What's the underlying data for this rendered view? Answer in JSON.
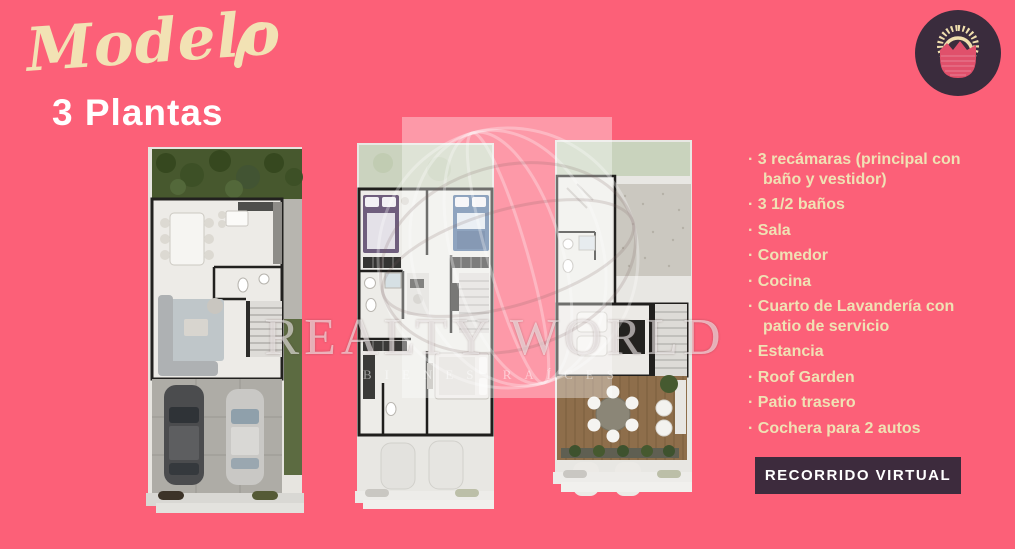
{
  "header": {
    "script_title": "Modelo",
    "subtitle": "3 Plantas"
  },
  "logo": {
    "icon": "sun-over-mountains-badge",
    "bg": "#3a2c3d",
    "sun": "#f0dfae",
    "mountain": "#e0506b"
  },
  "features": {
    "items": [
      "3 recámaras (principal con baño y vestidor)",
      "3 1/2 baños",
      "Sala",
      "Comedor",
      "Cocina",
      "Cuarto de Lavandería con patio de servicio",
      "Estancia",
      "Roof Garden",
      "Patio trasero",
      "Cochera para 2 autos"
    ]
  },
  "cta": {
    "label": "RECORRIDO VIRTUAL"
  },
  "watermark": {
    "title": "REALTY WORLD",
    "subtitle": "BIENES RAÍCES"
  },
  "colors": {
    "background": "#fc6078",
    "cream": "#f2e2b4",
    "dark_plum": "#3d2b3d",
    "white": "#ffffff"
  }
}
